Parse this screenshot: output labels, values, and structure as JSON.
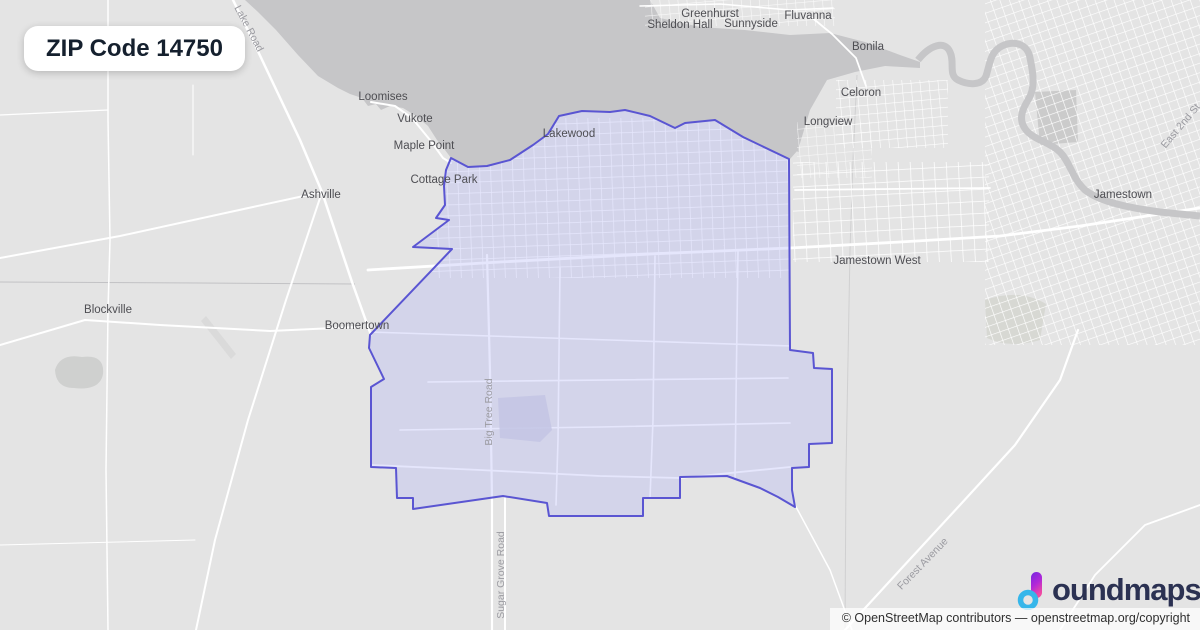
{
  "badge": {
    "title": "ZIP Code 14750"
  },
  "attribution": {
    "text": "© OpenStreetMap contributors — openstreetmap.org/copyright"
  },
  "logo": {
    "brand_rest": "oundmaps",
    "brand_full": "boundmaps"
  },
  "theme": {
    "land": "#e4e4e4",
    "water": "#c6c6c8",
    "road": "#ffffff",
    "boundary_stroke": "#5a55d2",
    "boundary_fill": "rgba(178,181,246,0.34)",
    "label_dark": "#4e4e53",
    "label_road": "#9b9ba1",
    "badge_text": "#15202e",
    "logo_navy": "#2b3152",
    "logo_blue": "#35b6ea",
    "logo_purple": "#7427e0",
    "logo_pink": "#ef4aa2"
  },
  "map": {
    "zip_code": "14750",
    "place_labels": [
      {
        "name": "Greenhurst"
      },
      {
        "name": "Sheldon Hall"
      },
      {
        "name": "Sunnyside"
      },
      {
        "name": "Fluvanna"
      },
      {
        "name": "Bonila"
      },
      {
        "name": "Celoron"
      },
      {
        "name": "Longview"
      },
      {
        "name": "Loomises"
      },
      {
        "name": "Vukote"
      },
      {
        "name": "Maple Point"
      },
      {
        "name": "Ashville"
      },
      {
        "name": "Cottage Park"
      },
      {
        "name": "Lakewood"
      },
      {
        "name": "Jamestown West"
      },
      {
        "name": "Jamestown"
      },
      {
        "name": "Blockville"
      },
      {
        "name": "Boomertown"
      }
    ],
    "road_labels": [
      {
        "name": "Lake Road"
      },
      {
        "name": "Big Tree Road"
      },
      {
        "name": "Sugar Grove Road"
      },
      {
        "name": "Forest Avenue"
      },
      {
        "name": "East 2nd St"
      }
    ]
  }
}
